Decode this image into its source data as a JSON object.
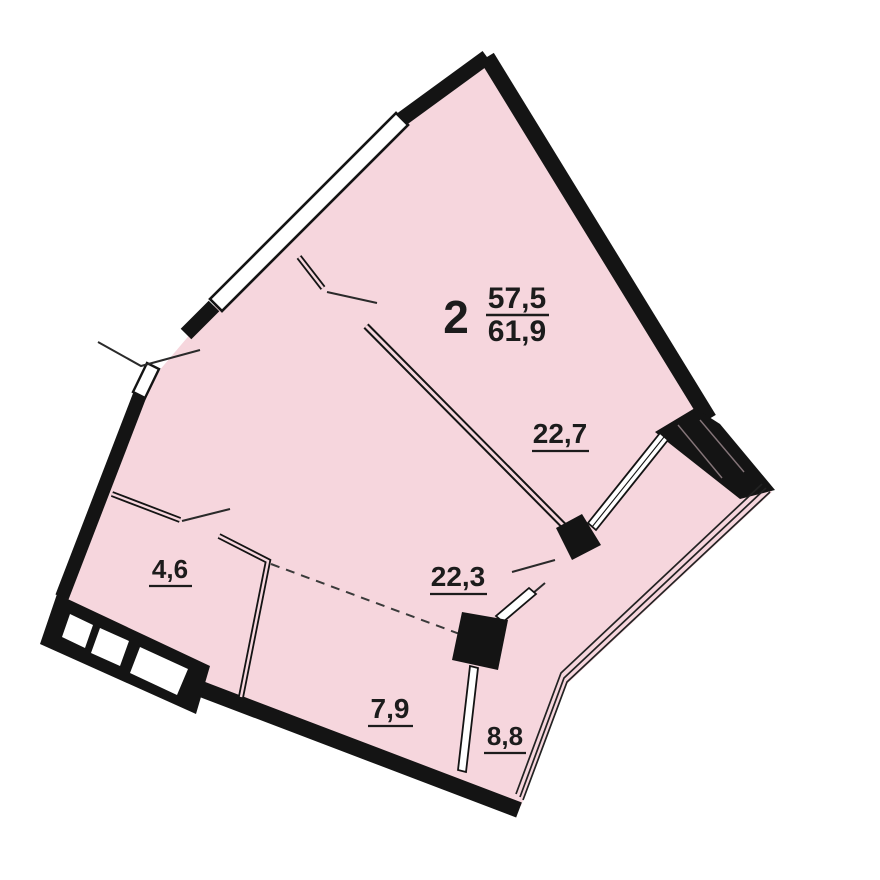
{
  "plan": {
    "apartment": {
      "rooms_count": "2",
      "living_area": "57,5",
      "total_area": "61,9"
    },
    "rooms": [
      {
        "id": "living-room",
        "area": "22,7"
      },
      {
        "id": "kitchen-living",
        "area": "22,3"
      },
      {
        "id": "hallway",
        "area": "4,6"
      },
      {
        "id": "kitchen-niche",
        "area": "7,9"
      },
      {
        "id": "balcony",
        "area": "8,8"
      }
    ],
    "colors": {
      "floor_fill": "#f6d6dd",
      "wall": "#141414",
      "line": "#1a1a1a",
      "background": "#ffffff"
    }
  }
}
